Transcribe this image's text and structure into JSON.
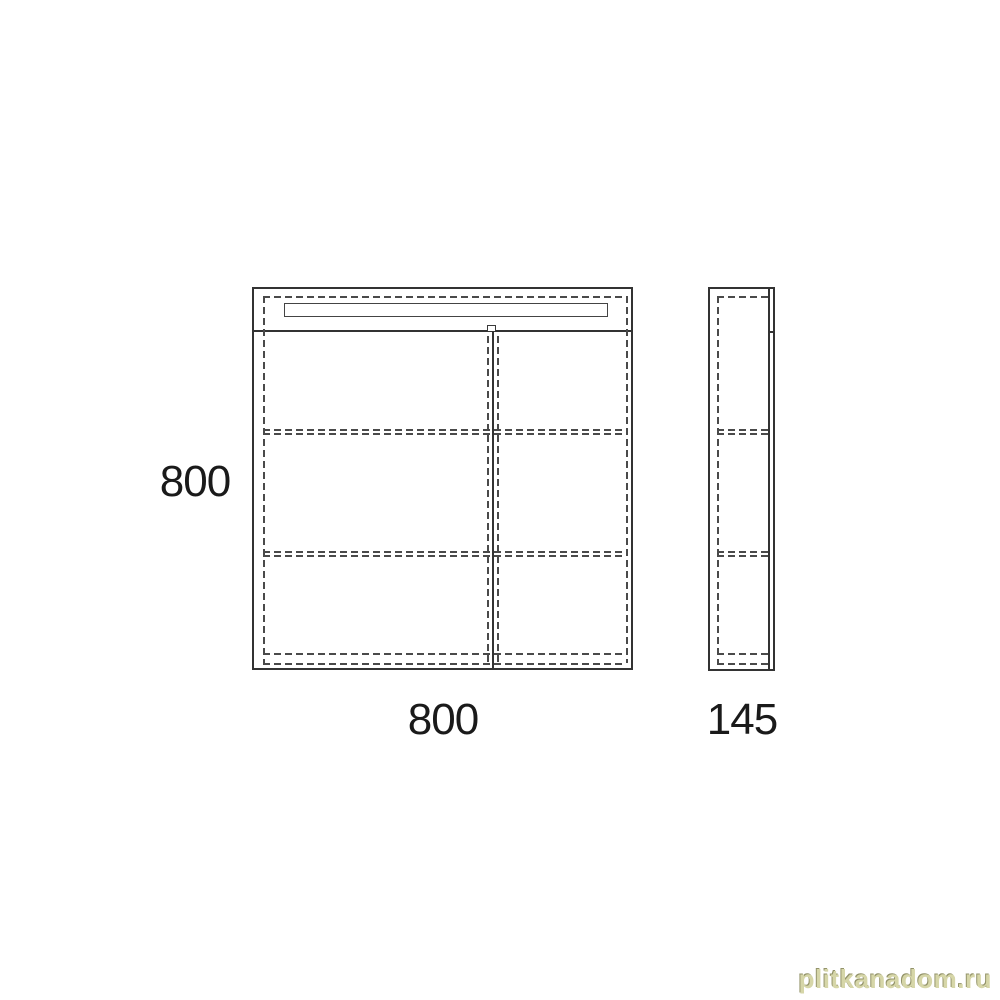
{
  "drawing": {
    "type": "furniture-technical-drawing",
    "front_view": {
      "height_label": "800",
      "width_label": "800"
    },
    "side_view": {
      "depth_label": "145"
    },
    "colors": {
      "line": "#333333",
      "dashed_line": "#4a4a4a",
      "background": "#ffffff"
    }
  },
  "watermark": {
    "text": "plitkanadom.ru",
    "color": "#d6d6a8"
  }
}
